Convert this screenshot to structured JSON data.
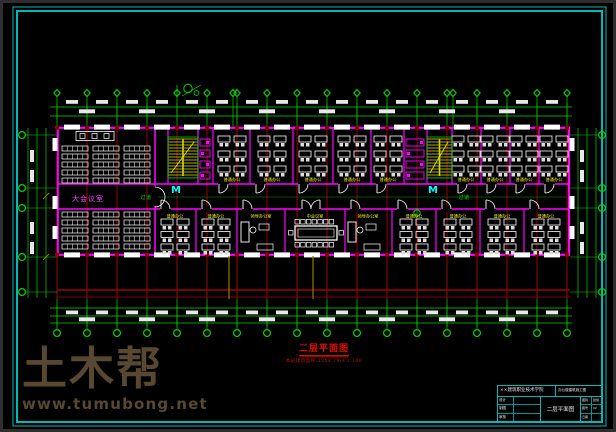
{
  "colors": {
    "frame": "#00b8b8",
    "axis_green": "#00d400",
    "axis_red": "#a00000",
    "wall": "#ff00ff",
    "furniture": "#ffffff",
    "dim_text": "#e8e8e8",
    "label_yellow": "#ffff00",
    "label_green": "#00dd00",
    "label_magenta": "#ff40ff",
    "elevator_cyan": "#00ffff",
    "stair_yellow": "#d8d800",
    "mustard": "#8f7a00",
    "caption_red": "#e11000",
    "pilaster": "#8b0000",
    "watermark": "#584731",
    "background": "#000000"
  },
  "watermark": {
    "brand": "土木帮",
    "site": "www.tumubong.net"
  },
  "plan_label": {
    "title": "二层平面图",
    "subtitle": "本层建筑面积:1268.79㎡  1:100"
  },
  "labels": {
    "hall": "大会议室",
    "corridor": "过道",
    "office": "普通办公",
    "exec_office": "领导办公室",
    "meeting": "中会议室",
    "elevator": "M"
  },
  "room_labels": [
    {
      "text": "大会议室",
      "x": 88,
      "y": 201,
      "color": "#ff40ff",
      "size": 7,
      "ls": 1,
      "name": "hall-label"
    },
    {
      "text": "过道",
      "x": 146,
      "y": 199,
      "color": "#00dd00",
      "size": 5,
      "ls": 0.5,
      "name": "corridor-label"
    },
    {
      "text": "过道",
      "x": 464,
      "y": 199,
      "color": "#00dd00",
      "size": 5,
      "ls": 0.5,
      "name": "corridor-label"
    },
    {
      "text": "领导办公室",
      "x": 261,
      "y": 217.5,
      "color": "#ffff00",
      "size": 4.2,
      "ls": 0,
      "name": "exec-office-label"
    },
    {
      "text": "中会议室",
      "x": 315,
      "y": 217.5,
      "color": "#ffff00",
      "size": 4.2,
      "ls": 0,
      "name": "meeting-room-label"
    },
    {
      "text": "领导办公室",
      "x": 368,
      "y": 217.5,
      "color": "#ffff00",
      "size": 4.2,
      "ls": 0,
      "name": "exec-office-label"
    }
  ],
  "title_block": {
    "org": "××建筑职业技术学院",
    "project": "办公楼建筑施工图",
    "rows": [
      {
        "label": "设计",
        "value": ""
      },
      {
        "label": "制图",
        "value": ""
      },
      {
        "label": "审核",
        "value": ""
      }
    ],
    "drawing": "二层平面图",
    "side": [
      {
        "label": "图别",
        "value": "建施"
      },
      {
        "label": "图号",
        "value": "02"
      },
      {
        "label": "日期",
        "value": ""
      }
    ]
  },
  "plan_geometry": {
    "axis_x": [
      57,
      87,
      117,
      147,
      177,
      207,
      237,
      267,
      297,
      327,
      357,
      387,
      417,
      447,
      477,
      507,
      537,
      567
    ],
    "axis_extra": [
      233,
      453
    ],
    "bubble_top_y": 93,
    "bubble_bottom_y": 333,
    "side_bubble_y": [
      135,
      188,
      208,
      257,
      292
    ],
    "left_bubble_x": 22,
    "right_bubble_x": 602,
    "building": {
      "x1": 57,
      "x2": 570,
      "y1": 127,
      "y2": 256,
      "corridor_y1": 184,
      "corridor_y2": 209
    },
    "hall": {
      "x1": 57,
      "x2": 155
    },
    "upper_walls": [
      155,
      168,
      198,
      213,
      250,
      293,
      333,
      371,
      404,
      427,
      452,
      481,
      510,
      539
    ],
    "lower_walls": [
      155,
      196,
      237,
      285,
      345,
      392,
      436,
      480,
      524
    ],
    "stairs": [
      [
        168,
        198
      ],
      [
        427,
        452
      ]
    ],
    "wc": [
      [
        198,
        213
      ],
      [
        404,
        427
      ]
    ],
    "upper_desk_cx": [
      232,
      272,
      313,
      352,
      388,
      466,
      495,
      524,
      554
    ],
    "lower_desk_cx": [
      175,
      216,
      414,
      458,
      502,
      546
    ],
    "exec_cx": [
      261,
      368
    ],
    "conference_cx": 315,
    "upper_door_x": [
      219,
      256,
      299,
      339,
      377,
      458,
      487,
      516,
      545
    ],
    "lower_door_x": [
      161,
      202,
      243,
      351,
      398,
      442,
      486,
      530
    ],
    "mustard_x": [
      229,
      313
    ],
    "elevator_x": [
      171,
      428
    ]
  }
}
